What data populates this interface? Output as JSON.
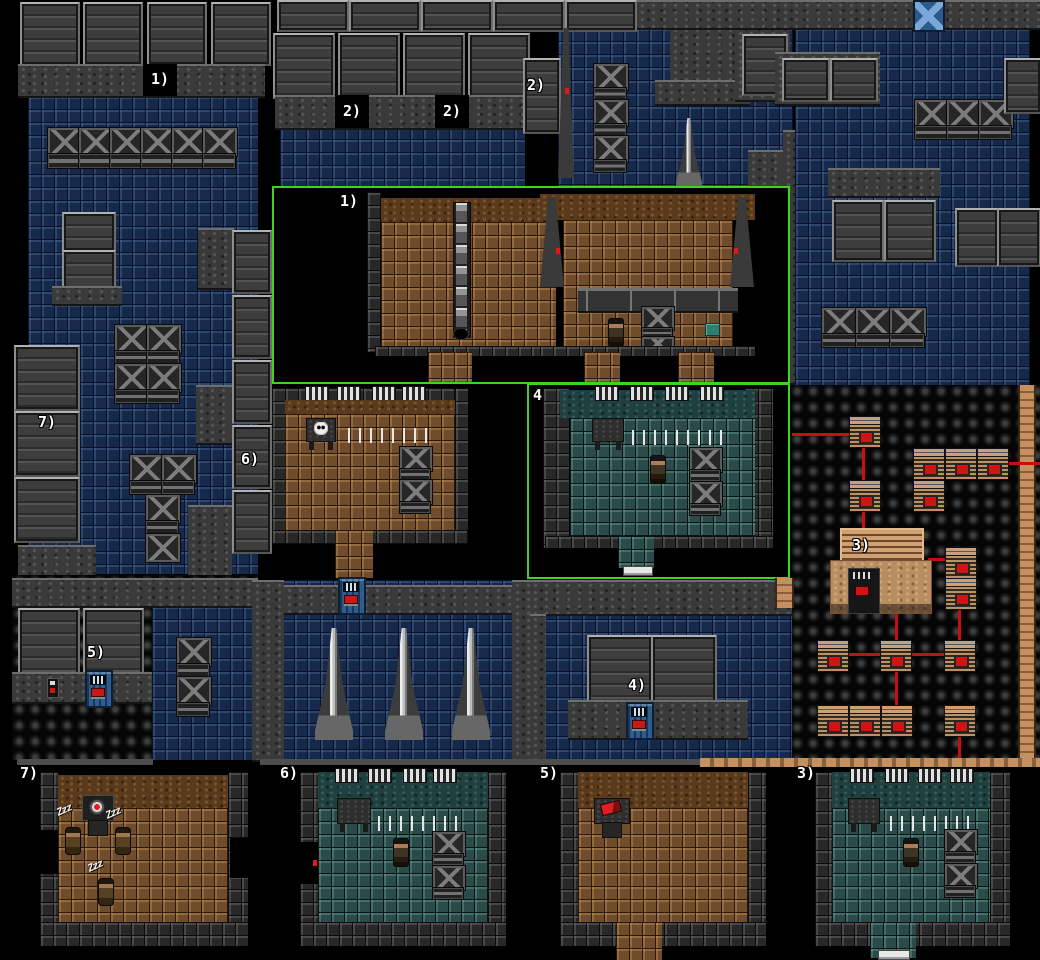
{
  "title": "Stealth facility overview map",
  "colors": {
    "highlight_outline": "#3fd51f",
    "connection_line": "#c41010",
    "floor_blue": "#16294b",
    "floor_brown": "#6f4c2b",
    "floor_teal": "#2b4b4a",
    "console_tan": "#c49a70",
    "door_blue": "#2d5c8f",
    "background": "#000000"
  },
  "door_markers": [
    {
      "id": "door-1",
      "label": "1)"
    },
    {
      "id": "door-2a",
      "label": "2)"
    },
    {
      "id": "door-2b",
      "label": "2)"
    },
    {
      "id": "door-2c",
      "label": "2)"
    }
  ],
  "wall_markers": [
    {
      "id": "wall-7",
      "label": "7)"
    },
    {
      "id": "wall-6",
      "label": "6)"
    },
    {
      "id": "wall-5",
      "label": "5)"
    },
    {
      "id": "wall-4",
      "label": "4)"
    },
    {
      "id": "building-3",
      "label": "3)"
    }
  ],
  "inset_rooms": [
    {
      "id": "inset-room-1",
      "label": "1)"
    },
    {
      "id": "inset-room-2",
      "label": "2)"
    },
    {
      "id": "inset-room-4",
      "label": "4)"
    }
  ],
  "bottom_rooms": [
    {
      "id": "detail-room-7",
      "label": "7)",
      "sleep": [
        "Zzz",
        "Zzz",
        "Zzz"
      ]
    },
    {
      "id": "detail-room-6",
      "label": "6)"
    },
    {
      "id": "detail-room-5",
      "label": "5)"
    },
    {
      "id": "detail-room-3",
      "label": "3)"
    }
  ]
}
